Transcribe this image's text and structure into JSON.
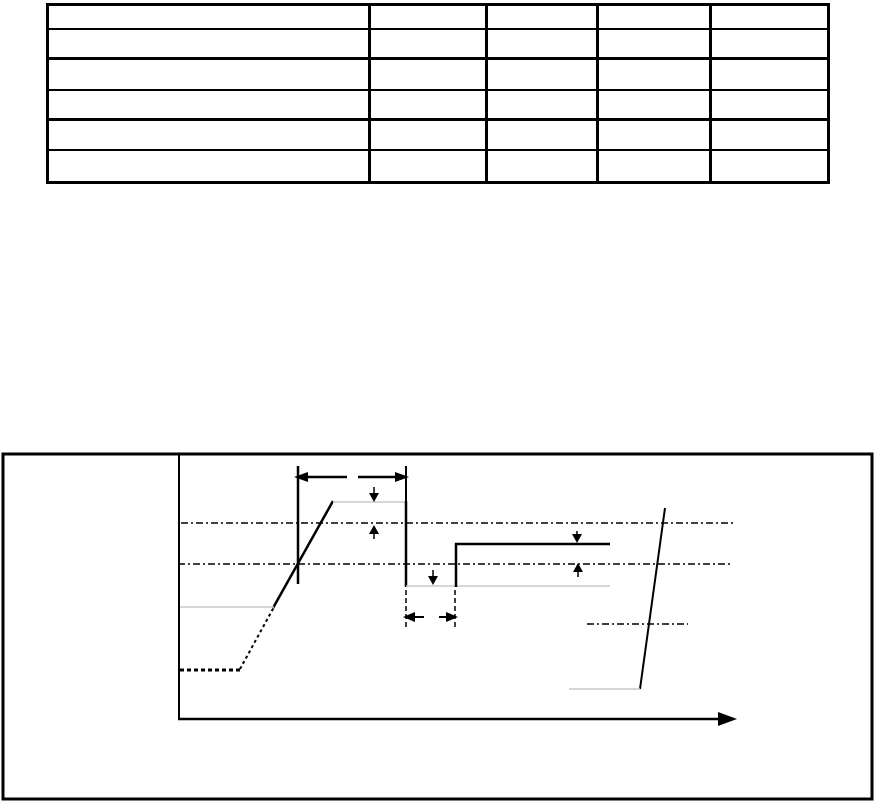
{
  "page": {
    "background": "#ffffff",
    "ink_color": "#000000",
    "gray_line_color": "#c9c9c9"
  },
  "table": {
    "rows": 6,
    "cols": 5,
    "thick_separators_after": [
      2,
      4
    ],
    "cells": [
      [
        "",
        "",
        "",
        "",
        ""
      ],
      [
        "",
        "",
        "",
        "",
        ""
      ],
      [
        "",
        "",
        "",
        "",
        ""
      ],
      [
        "",
        "",
        "",
        "",
        ""
      ],
      [
        "",
        "",
        "",
        "",
        ""
      ],
      [
        "",
        "",
        "",
        "",
        ""
      ]
    ]
  },
  "figure": {
    "type": "timing-diagram",
    "colors": {
      "black": "#000000",
      "gray": "#c9c9c9"
    },
    "elements": [
      {
        "name": "figure-border",
        "type": "rect",
        "x": 3,
        "y": 454,
        "w": 869,
        "h": 345,
        "width": 3
      },
      {
        "name": "y-axis",
        "type": "line",
        "x1": 179,
        "y1": 455,
        "x2": 179,
        "y2": 719,
        "width": 2
      },
      {
        "name": "x-axis",
        "type": "line",
        "x1": 178,
        "y1": 719,
        "x2": 722,
        "y2": 719,
        "width": 2.5
      },
      {
        "name": "x-axis-arrowhead",
        "type": "polygon",
        "points": "737,719 718,712 718,726"
      },
      {
        "name": "baseline-dotted",
        "type": "line",
        "x1": 180,
        "y1": 670,
        "x2": 240,
        "y2": 670,
        "width": 3,
        "dash": "4,3"
      },
      {
        "name": "ramp-dotted",
        "type": "line",
        "x1": 240,
        "y1": 669,
        "x2": 274,
        "y2": 607,
        "width": 2,
        "dash": "3,3"
      },
      {
        "name": "ramp-solid",
        "type": "line",
        "x1": 273,
        "y1": 608,
        "x2": 333,
        "y2": 501,
        "width": 2.5
      },
      {
        "name": "level-gray-left",
        "type": "line",
        "x1": 180,
        "y1": 607,
        "x2": 274,
        "y2": 607,
        "width": 1.5,
        "stroke": "gray"
      },
      {
        "name": "plateau1-gray",
        "type": "line",
        "x1": 333,
        "y1": 502,
        "x2": 406,
        "y2": 502,
        "width": 1.5,
        "stroke": "gray"
      },
      {
        "name": "falling-edge",
        "type": "line",
        "x1": 406,
        "y1": 501,
        "x2": 406,
        "y2": 587,
        "width": 2.5
      },
      {
        "name": "low-level-gray",
        "type": "line",
        "x1": 406,
        "y1": 586,
        "x2": 610,
        "y2": 586,
        "width": 1.5,
        "stroke": "gray"
      },
      {
        "name": "rising-edge",
        "type": "line",
        "x1": 456,
        "y1": 587,
        "x2": 456,
        "y2": 543,
        "width": 2.5
      },
      {
        "name": "plateau2",
        "type": "line",
        "x1": 455,
        "y1": 544,
        "x2": 610,
        "y2": 544,
        "width": 2.5
      },
      {
        "name": "threshold-line-high",
        "type": "line",
        "x1": 181,
        "y1": 523,
        "x2": 733,
        "y2": 523,
        "width": 1.5,
        "dash": "7,3,2,3"
      },
      {
        "name": "threshold-line-low",
        "type": "line",
        "x1": 178,
        "y1": 564,
        "x2": 733,
        "y2": 564,
        "width": 1.5,
        "dash": "7,3,2,3"
      },
      {
        "name": "right-edge-diagonal",
        "type": "line",
        "x1": 665,
        "y1": 508,
        "x2": 640,
        "y2": 689,
        "width": 2
      },
      {
        "name": "level-gray-bottom-right",
        "type": "line",
        "x1": 569,
        "y1": 689,
        "x2": 640,
        "y2": 689,
        "width": 1.5,
        "stroke": "gray"
      },
      {
        "name": "short-dashdot-segment",
        "type": "line",
        "x1": 587,
        "y1": 624,
        "x2": 688,
        "y2": 624,
        "width": 1.5,
        "dash": "7,3,2,3"
      },
      {
        "name": "measure-line-left",
        "type": "line",
        "x1": 298,
        "y1": 466,
        "x2": 298,
        "y2": 584,
        "width": 2.5
      },
      {
        "name": "measure-line-right",
        "type": "line",
        "x1": 406,
        "y1": 466,
        "x2": 406,
        "y2": 502,
        "width": 2
      },
      {
        "name": "top-dim-line-left",
        "type": "line",
        "x1": 302,
        "y1": 477,
        "x2": 347,
        "y2": 477,
        "width": 2.5
      },
      {
        "name": "top-dim-arrowhead-left",
        "type": "polygon",
        "points": "294,477 308,472 308,482"
      },
      {
        "name": "top-dim-line-right",
        "type": "line",
        "x1": 358,
        "y1": 477,
        "x2": 401,
        "y2": 477,
        "width": 2.5
      },
      {
        "name": "top-dim-arrowhead-right",
        "type": "polygon",
        "points": "409,477 395,472 395,482"
      },
      {
        "name": "overshoot-arrow-line",
        "type": "line",
        "x1": 374,
        "y1": 487,
        "x2": 374,
        "y2": 496,
        "width": 1.5
      },
      {
        "name": "overshoot-arrowhead",
        "type": "polygon",
        "points": "374,502 369,493 379,493"
      },
      {
        "name": "vih-arrow-line",
        "type": "line",
        "x1": 374,
        "y1": 532,
        "x2": 374,
        "y2": 539,
        "width": 1.5
      },
      {
        "name": "vih-arrowhead",
        "type": "polygon",
        "points": "374,525 369,534 379,534"
      },
      {
        "name": "undershoot-arrow-line",
        "type": "line",
        "x1": 433,
        "y1": 570,
        "x2": 433,
        "y2": 579,
        "width": 1.5
      },
      {
        "name": "undershoot-arrowhead",
        "type": "polygon",
        "points": "433,585 428,576 438,576"
      },
      {
        "name": "plateau2-arrow-line",
        "type": "line",
        "x1": 577,
        "y1": 531,
        "x2": 577,
        "y2": 538,
        "width": 1.5
      },
      {
        "name": "plateau2-arrowhead",
        "type": "polygon",
        "points": "577,543 572,534 582,534"
      },
      {
        "name": "vil-arrow-line",
        "type": "line",
        "x1": 578,
        "y1": 570,
        "x2": 578,
        "y2": 577,
        "width": 1.5
      },
      {
        "name": "vil-arrowhead",
        "type": "polygon",
        "points": "578,563 573,572 583,572"
      },
      {
        "name": "pulse-ext-line-left",
        "type": "line",
        "x1": 406,
        "y1": 590,
        "x2": 406,
        "y2": 628,
        "width": 1.5,
        "dash": "5,3"
      },
      {
        "name": "pulse-ext-line-right",
        "type": "line",
        "x1": 455,
        "y1": 590,
        "x2": 455,
        "y2": 628,
        "width": 1.5,
        "dash": "5,3"
      },
      {
        "name": "pulse-dim-line-left",
        "type": "line",
        "x1": 413,
        "y1": 617,
        "x2": 424,
        "y2": 617,
        "width": 2
      },
      {
        "name": "pulse-dim-arrowhead-left",
        "type": "polygon",
        "points": "403,617 415,612 415,622"
      },
      {
        "name": "pulse-dim-line-right",
        "type": "line",
        "x1": 439,
        "y1": 617,
        "x2": 448,
        "y2": 617,
        "width": 2
      },
      {
        "name": "pulse-dim-arrowhead-right",
        "type": "polygon",
        "points": "458,617 446,612 446,622"
      }
    ]
  }
}
